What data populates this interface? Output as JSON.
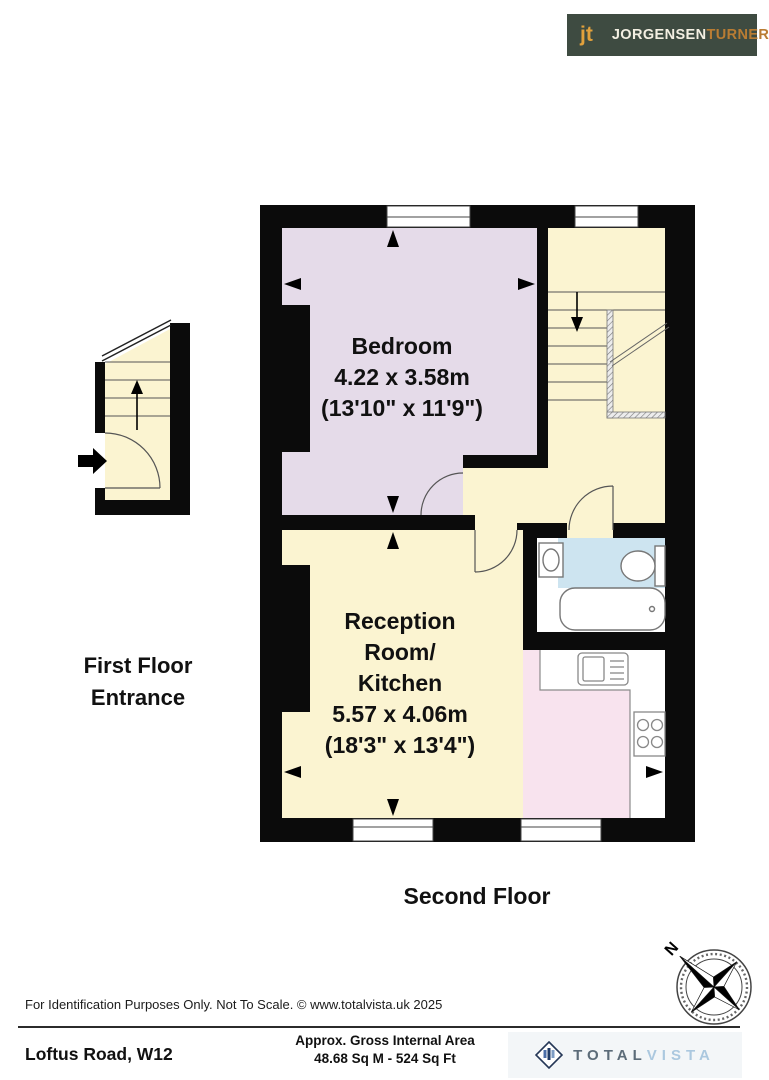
{
  "header_logo": {
    "monogram": "jt",
    "brand_primary": "JORGENSEN",
    "brand_secondary": "TURNER"
  },
  "plan": {
    "floor_label": "Second Floor",
    "entrance_label": {
      "line1": "First Floor",
      "line2": "Entrance"
    },
    "rooms": {
      "bedroom": {
        "name": "Bedroom",
        "dimensions_metric": "4.22 x 3.58m",
        "dimensions_imperial": "(13'10\" x 11'9\")"
      },
      "reception": {
        "name_line1": "Reception",
        "name_line2": "Room/",
        "name_line3": "Kitchen",
        "dimensions_metric": "5.57 x 4.06m",
        "dimensions_imperial": "(18'3\" x 13'4\")"
      }
    },
    "compass": {
      "north_label": "N"
    },
    "colors": {
      "wall": "#0b0b0b",
      "bedroom": "#e5dbe9",
      "hall": "#fbf4d1",
      "bathroom_floor": "#cde4f0",
      "kitchen_floor": "#f8e3ee"
    }
  },
  "footer": {
    "disclaimer": "For Identification Purposes Only. Not To Scale. © www.totalvista.uk  2025",
    "address": "Loftus Road, W12",
    "area_label": "Approx. Gross Internal Area",
    "area_value": "48.68 Sq M - 524 Sq Ft",
    "vendor_logo": {
      "word1": "TOTAL",
      "word2": "VISTA"
    }
  }
}
